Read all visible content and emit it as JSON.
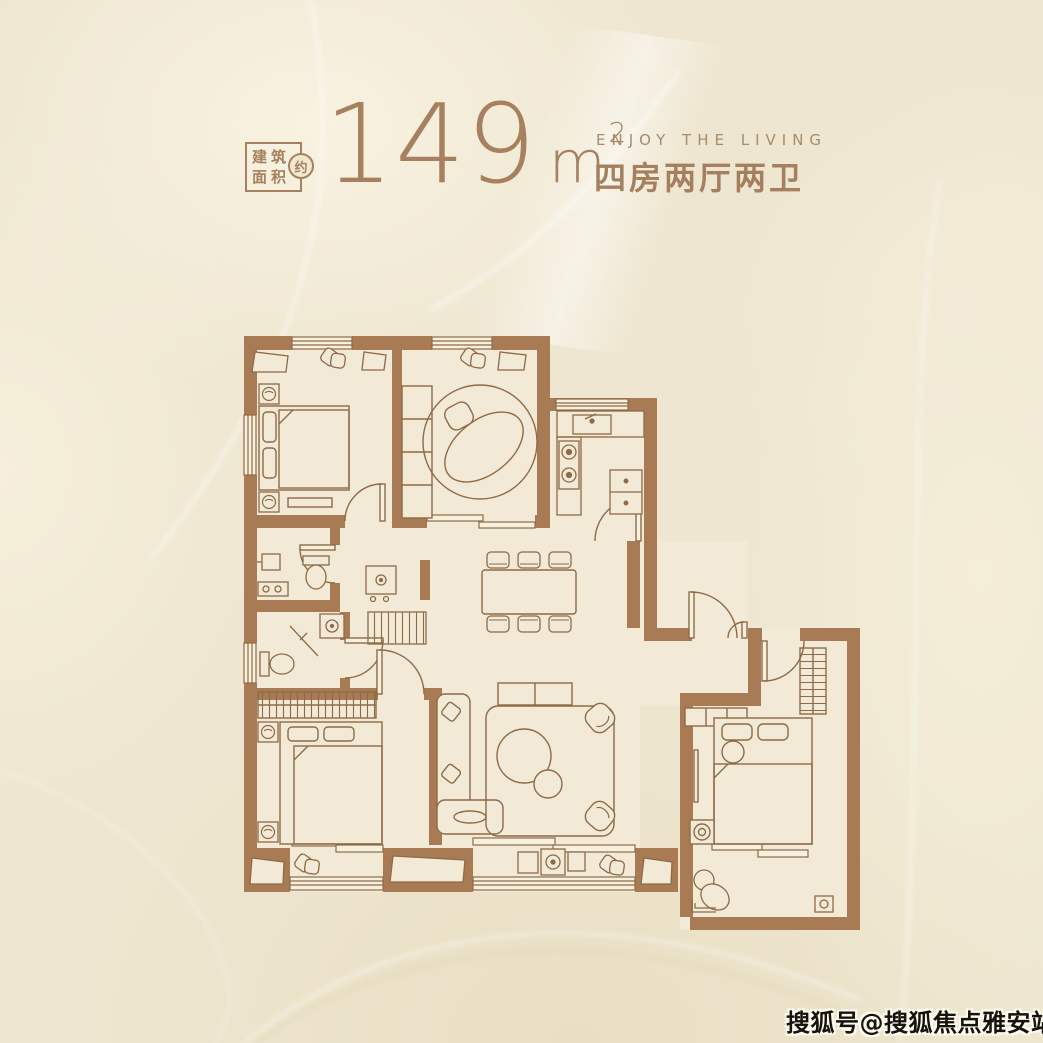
{
  "poster": {
    "header": {
      "area_box": {
        "line1": "建筑",
        "line2": "面积",
        "approx": "约"
      },
      "area": {
        "value": "149",
        "unit": "m",
        "sup": "2"
      },
      "tagline_en": "ENJOY THE LIVING",
      "tagline_cn": "四房两厅两卫"
    },
    "watermark": "搜狐号@搜狐焦点雅安站",
    "colors": {
      "background": "#eee6d0",
      "wall": "#a87b54",
      "line": "#8f6a47",
      "accent_text": "#a6805f",
      "watermark_text": "#16120c"
    },
    "floorplan": {
      "icons": [
        "bed-icon",
        "pillow-icon",
        "wardrobe-icon",
        "round-rug-icon",
        "armchair-icon",
        "dining-table-icon",
        "chair-icon",
        "sofa-icon",
        "coffee-table-icon",
        "toilet-icon",
        "washbasin-icon",
        "shower-icon",
        "washer-icon",
        "kitchen-sink-icon",
        "stove-icon",
        "fridge-icon",
        "door-icon",
        "window-icon",
        "nightstand-icon",
        "floor-drain-icon",
        "side-table-icon"
      ]
    }
  }
}
